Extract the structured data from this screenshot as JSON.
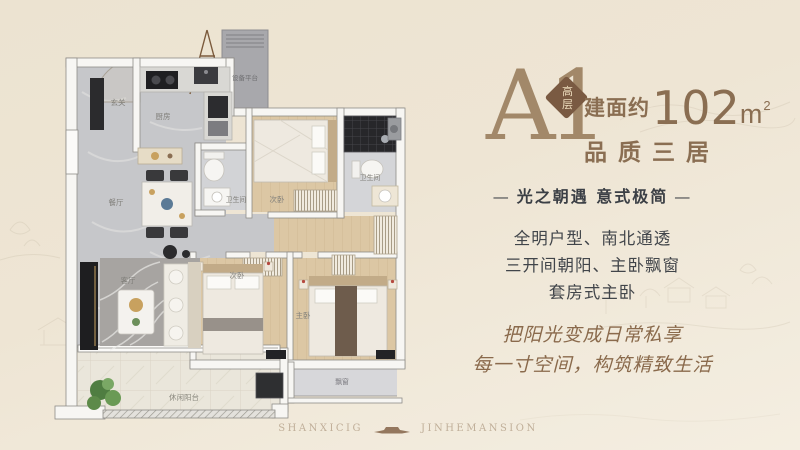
{
  "header": {
    "unit": "A1",
    "badge": "高层",
    "area_prefix": "建面约",
    "area_number": "102",
    "area_unit": "m",
    "area_exponent": "2",
    "subtitle": "品质三居"
  },
  "tagline": {
    "dash_left": "—",
    "text": "光之朝遇 意式极简",
    "dash_right": "—"
  },
  "features": [
    "全明户型、南北通透",
    "三开间朝阳、主卧飘窗",
    "套房式主卧"
  ],
  "slogans": [
    "把阳光变成日常私享",
    "每一寸空间，构筑精致生活"
  ],
  "footer": {
    "brand_left": "SHANXICIG",
    "brand_right": "JINHEMANSION"
  },
  "floorplan": {
    "labels": [
      {
        "room": "entry",
        "text": "玄关"
      },
      {
        "room": "kitchen",
        "text": "厨房"
      },
      {
        "room": "equipment-platform",
        "text": "设备平台"
      },
      {
        "room": "dining-room",
        "text": "餐厅"
      },
      {
        "room": "bathroom-1",
        "text": "卫生间"
      },
      {
        "room": "bedroom-2",
        "text": "次卧"
      },
      {
        "room": "bathroom-2",
        "text": "卫生间"
      },
      {
        "room": "living-room",
        "text": "客厅"
      },
      {
        "room": "bedroom-3",
        "text": "次卧"
      },
      {
        "room": "master-bedroom",
        "text": "主卧"
      },
      {
        "room": "leisure-balcony",
        "text": "休闲阳台"
      },
      {
        "room": "bay-window",
        "text": "飘窗"
      }
    ]
  },
  "colors": {
    "accent_brown": "#8a6e52",
    "unit_brown": "#a28869",
    "badge_brown": "#7a5a42",
    "text_dark": "#3d4147",
    "script_brown": "#8a6a4c",
    "logo_tan": "#c0af99",
    "background": "#eee5d4"
  }
}
